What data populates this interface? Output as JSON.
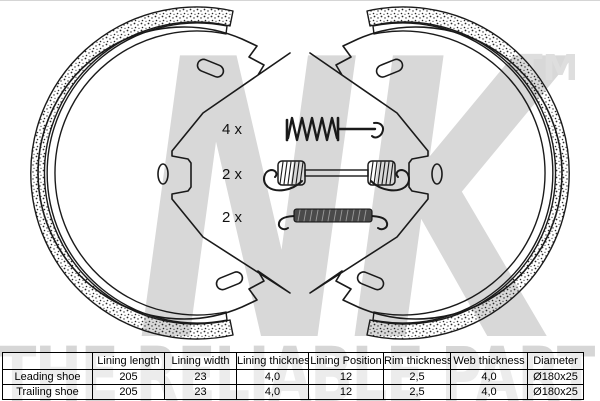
{
  "branding": {
    "logo_text": "NK",
    "trademark": "TM",
    "slogan": "THE RELIABLE PART"
  },
  "colors": {
    "watermark_gray": "#d8d8d8",
    "line_art": "#1a1a1a",
    "spring_body_dark": "#4a4a4a"
  },
  "diagram": {
    "description": "Parking brake shoe set with fitting springs",
    "items": [
      {
        "qty": "4 x",
        "name": "hold-down-pin-spring"
      },
      {
        "qty": "2 x",
        "name": "long-return-spring"
      },
      {
        "qty": "2 x",
        "name": "short-adjuster-spring"
      }
    ]
  },
  "table": {
    "columns": [
      "",
      "Lining length",
      "Lining width",
      "Lining thickness",
      "Lining Position",
      "Rim thickness",
      "Web thickness",
      "Diameter"
    ],
    "rows": [
      {
        "label": "Leading shoe",
        "values": [
          "205",
          "23",
          "4,0",
          "12",
          "2,5",
          "4,0",
          "Ø180x25"
        ]
      },
      {
        "label": "Trailing shoe",
        "values": [
          "205",
          "23",
          "4,0",
          "12",
          "2,5",
          "4,0",
          "Ø180x25"
        ]
      }
    ]
  }
}
